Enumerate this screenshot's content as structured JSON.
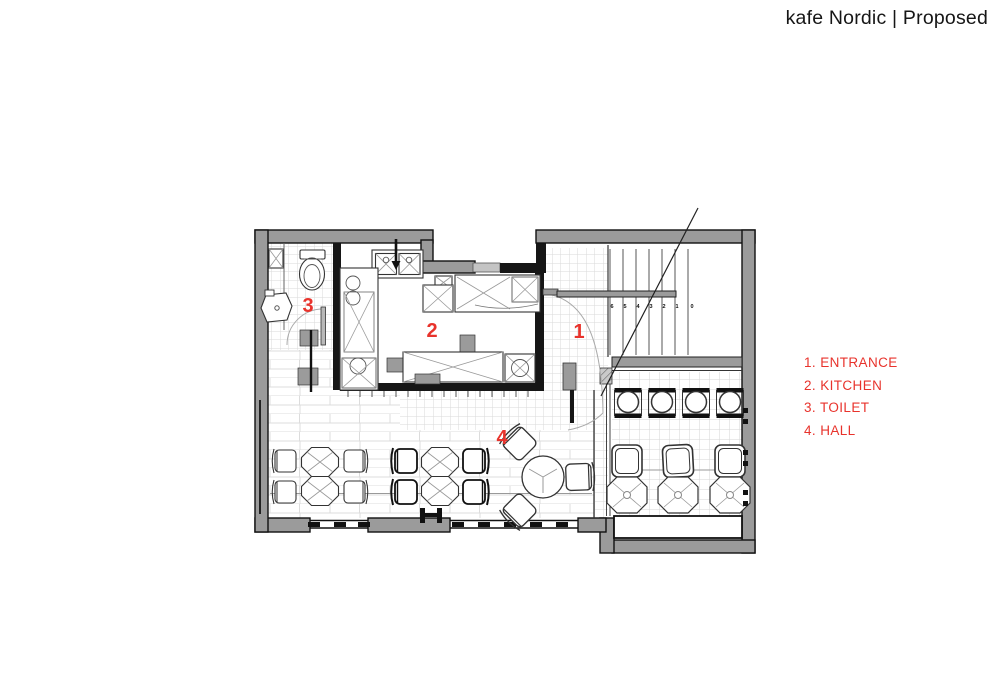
{
  "title": "kafe Nordic | Proposed",
  "legend": {
    "items": [
      "1. ENTRANCE",
      "2. KITCHEN",
      "3. TOILET",
      "4. HALL"
    ],
    "color": "#e8332c"
  },
  "plan": {
    "room_markers": {
      "entrance": "1",
      "kitchen": "2",
      "toilet": "3",
      "hall": "4"
    },
    "stairs": {
      "tread_numbers": [
        "6",
        "5",
        "4",
        "3",
        "2",
        "1",
        "0"
      ]
    },
    "colors": {
      "wall_gray": "#9b9b9b",
      "line_black": "#161616",
      "accent_red": "#e8332c"
    }
  }
}
